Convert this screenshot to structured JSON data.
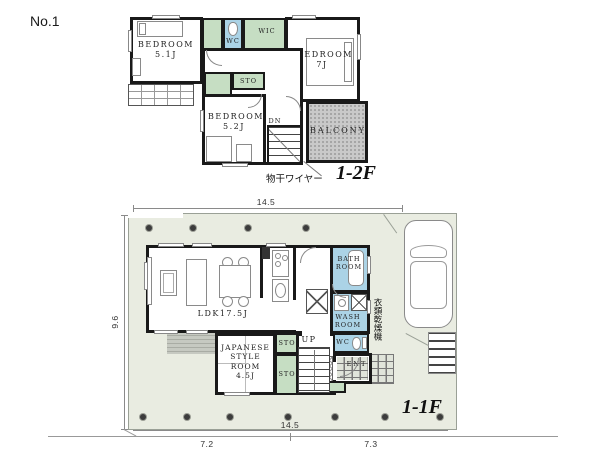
{
  "page": {
    "plan_number": "No.1"
  },
  "floor2": {
    "floor_label": "1-2F",
    "laundry_wire_note": "物干ワイヤー",
    "rooms": {
      "bedroom_51": "BEDROOM\n5.1J",
      "wc": "WC",
      "wic": "WIC",
      "bedroom_7": "BEDROOM\n7J",
      "storage": "STO",
      "bedroom_52": "BEDROOM\n5.2J",
      "stairs_down": "DN",
      "balcony": "BALCONY"
    }
  },
  "floor1": {
    "floor_label": "1-1F",
    "dryer_note": "衣類乾燥機",
    "rooms": {
      "ldk": "LDK17.5J",
      "japanese_room": "JAPANESE\nSTYLE\nROOM\n4.5J",
      "storage_upper": "STO",
      "storage_lower": "STO",
      "stairs_up": "UP",
      "bath": "BATH\nROOM",
      "wash": "WASH\nROOM",
      "wc": "WC",
      "entrance": "ENT"
    },
    "dimensions": {
      "width_top": "14.5",
      "height_left": "9.6",
      "width_bottom": "14.5",
      "width_bottom_left": "7.2",
      "width_bottom_right": "7.3"
    }
  },
  "colors": {
    "wall": "#191919",
    "storage_green": "#c6dec3",
    "water_blue": "#abd3e6",
    "balcony_gray": "#c9c9c9",
    "lot_green": "#e9ece1"
  }
}
